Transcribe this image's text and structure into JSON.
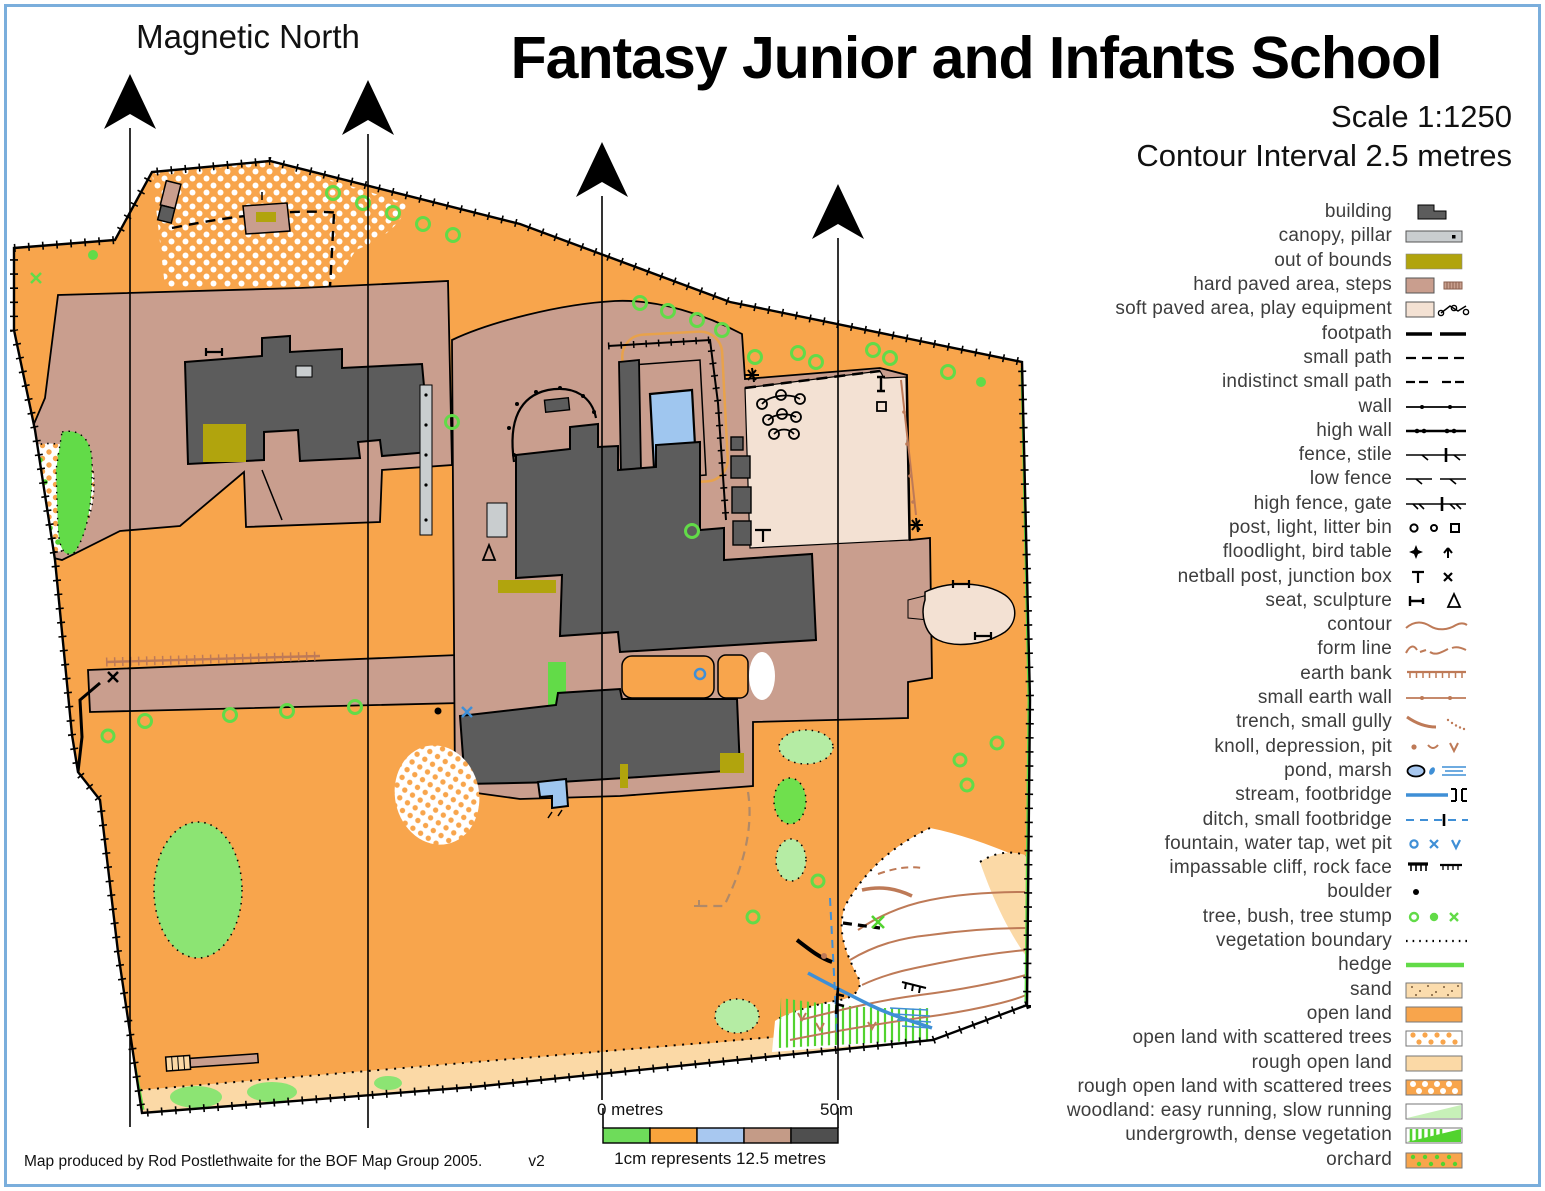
{
  "header": {
    "title": "Fantasy Junior and Infants School",
    "scale": "Scale 1:1250",
    "contour_interval": "Contour Interval 2.5 metres",
    "magnetic_north": "Magnetic North"
  },
  "legend": {
    "items": [
      {
        "label": "building"
      },
      {
        "label": "canopy, pillar"
      },
      {
        "label": "out of bounds"
      },
      {
        "label": "hard paved area, steps"
      },
      {
        "label": "soft paved area, play equipment"
      },
      {
        "label": "footpath"
      },
      {
        "label": "small path"
      },
      {
        "label": "indistinct small path"
      },
      {
        "label": "wall"
      },
      {
        "label": "high wall"
      },
      {
        "label": "fence, stile"
      },
      {
        "label": "low fence"
      },
      {
        "label": "high fence, gate"
      },
      {
        "label": "post, light, litter bin"
      },
      {
        "label": "floodlight, bird table"
      },
      {
        "label": "netball post, junction box"
      },
      {
        "label": "seat, sculpture"
      },
      {
        "label": "contour"
      },
      {
        "label": "form line"
      },
      {
        "label": "earth bank"
      },
      {
        "label": "small earth wall"
      },
      {
        "label": "trench, small gully"
      },
      {
        "label": "knoll, depression, pit"
      },
      {
        "label": "pond, marsh"
      },
      {
        "label": "stream, footbridge"
      },
      {
        "label": "ditch, small footbridge"
      },
      {
        "label": "fountain, water tap, wet pit"
      },
      {
        "label": "impassable cliff, rock face"
      },
      {
        "label": "boulder"
      },
      {
        "label": "tree, bush, tree stump"
      },
      {
        "label": "vegetation boundary"
      },
      {
        "label": "hedge"
      },
      {
        "label": "sand"
      },
      {
        "label": "open land"
      },
      {
        "label": "open land with scattered trees"
      },
      {
        "label": "rough open land"
      },
      {
        "label": "rough open land with scattered trees"
      },
      {
        "label": "woodland: easy running,  slow running"
      },
      {
        "label": "undergrowth, dense vegetation"
      },
      {
        "label": "orchard"
      }
    ]
  },
  "scalebar": {
    "start_label": "0 metres",
    "end_label": "50m",
    "caption": "1cm represents 12.5 metres"
  },
  "attribution": {
    "credit": "Map produced by Rod Postlethwaite for the BOF Map Group 2005.",
    "version": "v2"
  },
  "colors": {
    "open_land": "#F8A54C",
    "rough_open_land": "#FBD9A6",
    "hard_paved": "#C99E8E",
    "soft_paved": "#F3E1D3",
    "building": "#5C5C5C",
    "canopy": "#C9CDCF",
    "out_of_bounds": "#B1A40D",
    "pool_blue": "#9FC6EF",
    "water_blue": "#3F8FD6",
    "hedge_green": "#62DB48",
    "light_green": "#B5ECA4",
    "dense_green": "#52D32F",
    "contour_brown": "#BE7A57",
    "frame_blue": "#7AAEDC"
  }
}
